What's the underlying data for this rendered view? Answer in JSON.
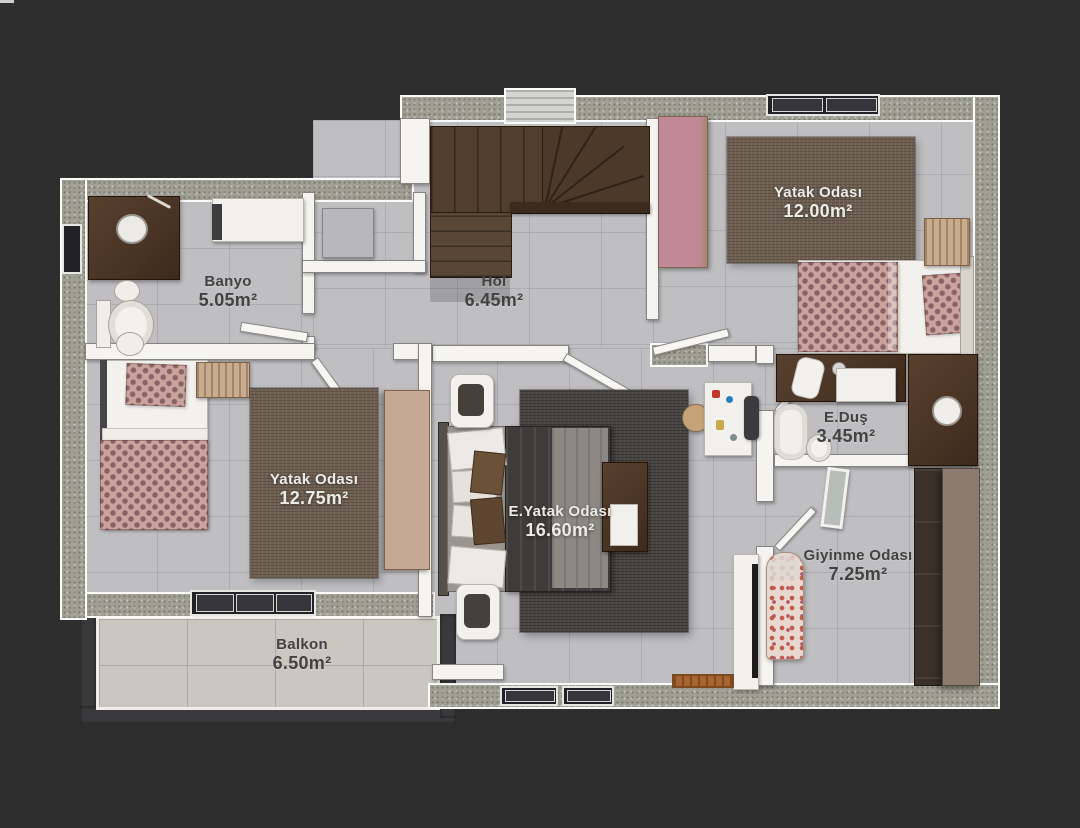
{
  "rooms": {
    "banyo": {
      "name": "Banyo",
      "area": "5.05m²",
      "furniture": [
        "vanity-with-sink",
        "washing-machine",
        "hand-sink",
        "toilet",
        "bidet",
        "storage-box",
        "window"
      ]
    },
    "hol": {
      "name": "Hol",
      "area": "6.45m²",
      "furniture": [
        "staircase",
        "stair-railing",
        "chimney-shaft",
        "utility-niche"
      ]
    },
    "yatak_odasi_1": {
      "name": "Yatak Odası",
      "area": "12.00m²",
      "furniture": [
        "wardrobe",
        "area-rug",
        "single-bed",
        "patterned-duvet",
        "patterned-pillow",
        "wicker-dresser",
        "window"
      ]
    },
    "yatak_odasi_2": {
      "name": "Yatak Odası",
      "area": "12.75m²",
      "furniture": [
        "single-bed",
        "patterned-duvet",
        "patterned-pillow",
        "wicker-ottoman",
        "area-rug",
        "wardrobe",
        "window"
      ]
    },
    "e_yatak_odasi": {
      "name": "E.Yatak Odası",
      "area": "16.60m²",
      "furniture": [
        "double-bed",
        "pillows",
        "nightstand",
        "nightstand",
        "area-rug",
        "bench-with-tray",
        "dressing-table",
        "chair",
        "pouf",
        "tv-unit",
        "doormat",
        "windows"
      ]
    },
    "e_dus": {
      "name": "E.Duş",
      "area": "3.45m²",
      "furniture": [
        "counter-with-towel",
        "shower-tray",
        "shower",
        "toilet",
        "vanity-with-sink"
      ]
    },
    "giyinme_odasi": {
      "name": "Giyinme Odası",
      "area": "7.25m²",
      "furniture": [
        "wardrobe",
        "mirror-panel",
        "ironing-board"
      ]
    },
    "balkon": {
      "name": "Balkon",
      "area": "6.50m²",
      "furniture": [
        "railing"
      ]
    }
  },
  "colors": {
    "bg": "#2e2e2f",
    "exterior_wall": "#a09f94",
    "wall": "#f5f4f1",
    "floor": "#bfbec1",
    "floor_niche": "#b3b3b6",
    "floor_balcony": "#cac7c1",
    "rug_brown": "#6e5f51",
    "rug_dark": "#494542",
    "stair_wood": "#523e2d",
    "railing_wood": "#3a2b1e",
    "wood_dark": "#4a3425",
    "wardrobe_tan": "#c6a894",
    "wardrobe_taupe": "#8c7c6f",
    "wardrobe_dark": "#39312a",
    "fabric_base": "#c8a49c",
    "fabric_motif": "#8a6266",
    "window_dark": "#222226",
    "balcony_rail": "#3a3a3c",
    "label_dark": "#424242",
    "label_light": "#edebe7",
    "door_white": "#f7f6f3",
    "doormat_orange": "#a8642f"
  }
}
